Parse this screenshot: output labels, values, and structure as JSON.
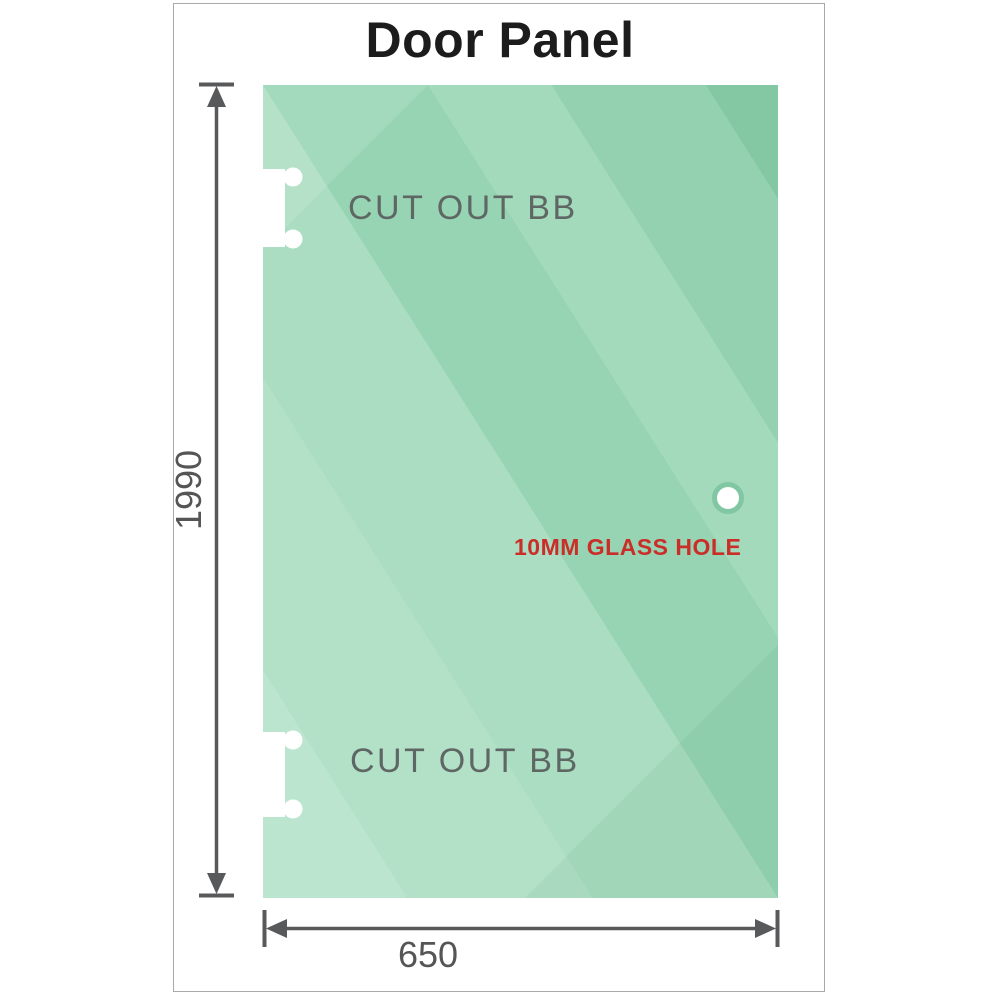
{
  "title": "Door Panel",
  "drawing": {
    "cutouts": [
      {
        "label": "CUT OUT BB",
        "position": "top-left"
      },
      {
        "label": "CUT OUT BB",
        "position": "bottom-left"
      }
    ],
    "hole": {
      "label": "10MM GLASS HOLE"
    },
    "dimensions": {
      "height": {
        "value": "1990"
      },
      "width": {
        "value": "650"
      }
    },
    "colors": {
      "glass_green_dark": "#83c8a2",
      "glass_green_light": "#bce5cf",
      "hole_label_red": "#ca2e28",
      "cutout_label_gray": "#5f6765",
      "dimension_gray": "#58595b",
      "title_black": "#1c1c1c",
      "frame_border_gray": "#a9a9a9"
    }
  }
}
